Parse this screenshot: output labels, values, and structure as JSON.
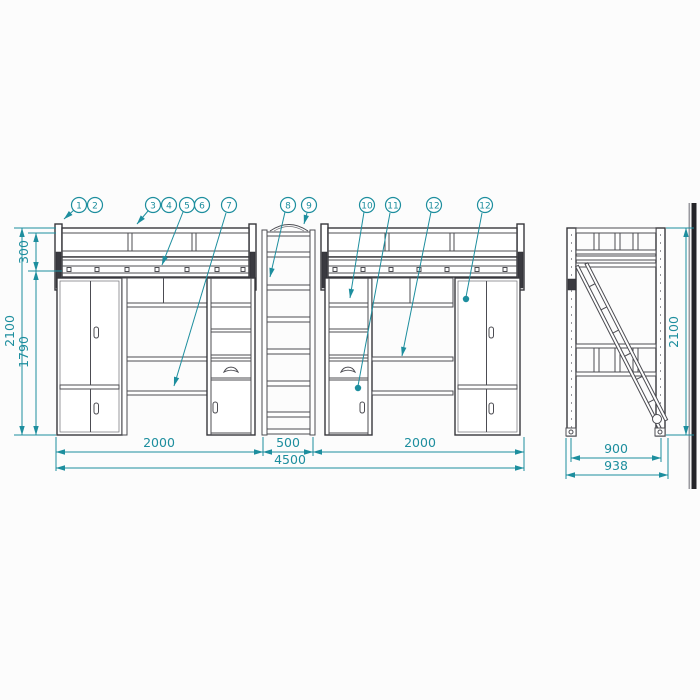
{
  "drawing": {
    "kind": "loft-bed furniture technical drawing, front and side elevations",
    "views": [
      "front-elevation",
      "side-elevation"
    ]
  },
  "callouts": [
    {
      "label": "1"
    },
    {
      "label": "2"
    },
    {
      "label": "3"
    },
    {
      "label": "4"
    },
    {
      "label": "5"
    },
    {
      "label": "6"
    },
    {
      "label": "7"
    },
    {
      "label": "8"
    },
    {
      "label": "9"
    },
    {
      "label": "10"
    },
    {
      "label": "11"
    },
    {
      "label": "12"
    },
    {
      "label": "12"
    }
  ],
  "dimensions": {
    "front": {
      "height_total": "2100",
      "guardrail_height": "300",
      "under_bed_clearance": "1790",
      "left_section_width": "2000",
      "ladder_width": "500",
      "right_section_width": "2000",
      "total_width": "4500"
    },
    "side": {
      "height_total": "2100",
      "depth": "900",
      "total_depth": "938"
    }
  },
  "colors": {
    "dimension_teal": "#1d8e9e",
    "line_dark": "#4c4c52",
    "edge_bar_dark": "#242428",
    "edge_bar_gray": "#9a9aa0",
    "background": "#fcfcfc"
  }
}
